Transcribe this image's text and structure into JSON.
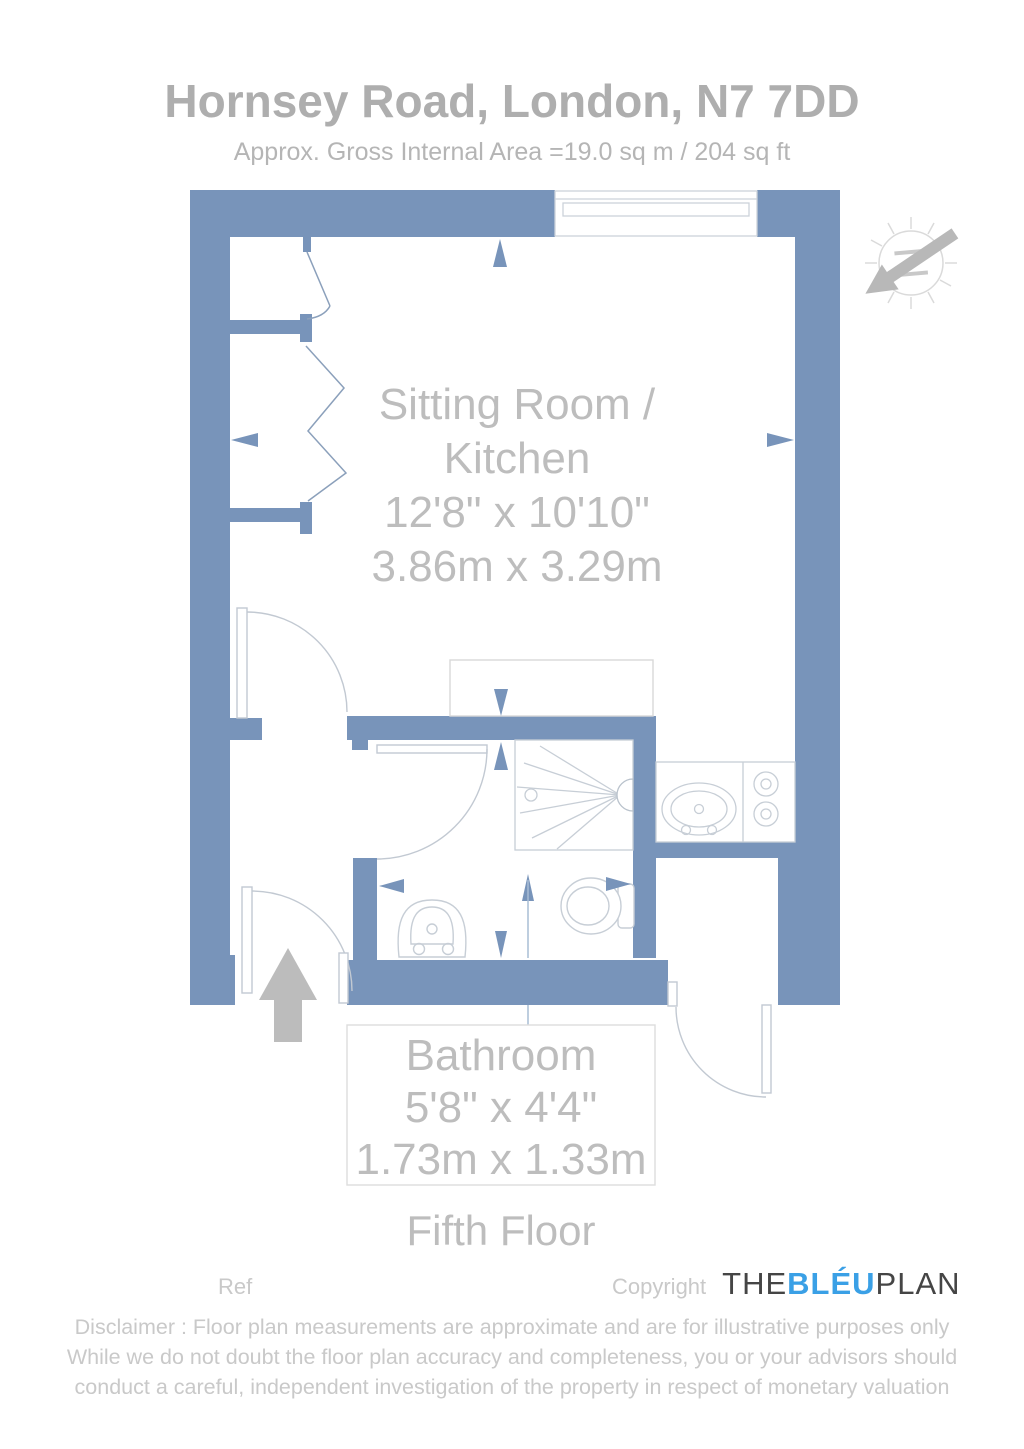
{
  "header": {
    "title": "Hornsey Road, London, N7 7DD",
    "subtitle": "Approx. Gross Internal Area =19.0 sq m / 204 sq ft"
  },
  "plan": {
    "sitting_room": {
      "label_line1": "Sitting Room /",
      "label_line2": "Kitchen",
      "dimensions_imperial": "12'8\" x 10'10\"",
      "dimensions_metric": "3.86m x 3.29m"
    },
    "bathroom": {
      "label": "Bathroom",
      "dimensions_imperial": "5'8\" x 4'4\"",
      "dimensions_metric": "1.73m x 1.33m"
    },
    "floor_label": "Fifth Floor",
    "compass_letter": "N",
    "colors": {
      "wall_blue": "#7894ba",
      "fixture_line": "#c4cbd4",
      "entry_arrow_gray": "#bcbcbc",
      "brand_blue": "#3aa0e6"
    }
  },
  "footer": {
    "ref_label": "Ref",
    "copyright_label": "Copyright",
    "brand": {
      "the": "THE",
      "bleu": "BLÉU",
      "plan": "PLAN"
    },
    "disclaimer_lines": [
      "Disclaimer : Floor plan measurements are approximate and are for illustrative purposes only",
      "While we do not doubt the floor plan accuracy and completeness, you or your advisors should",
      "conduct a careful, independent investigation of the property in respect of monetary valuation"
    ]
  }
}
